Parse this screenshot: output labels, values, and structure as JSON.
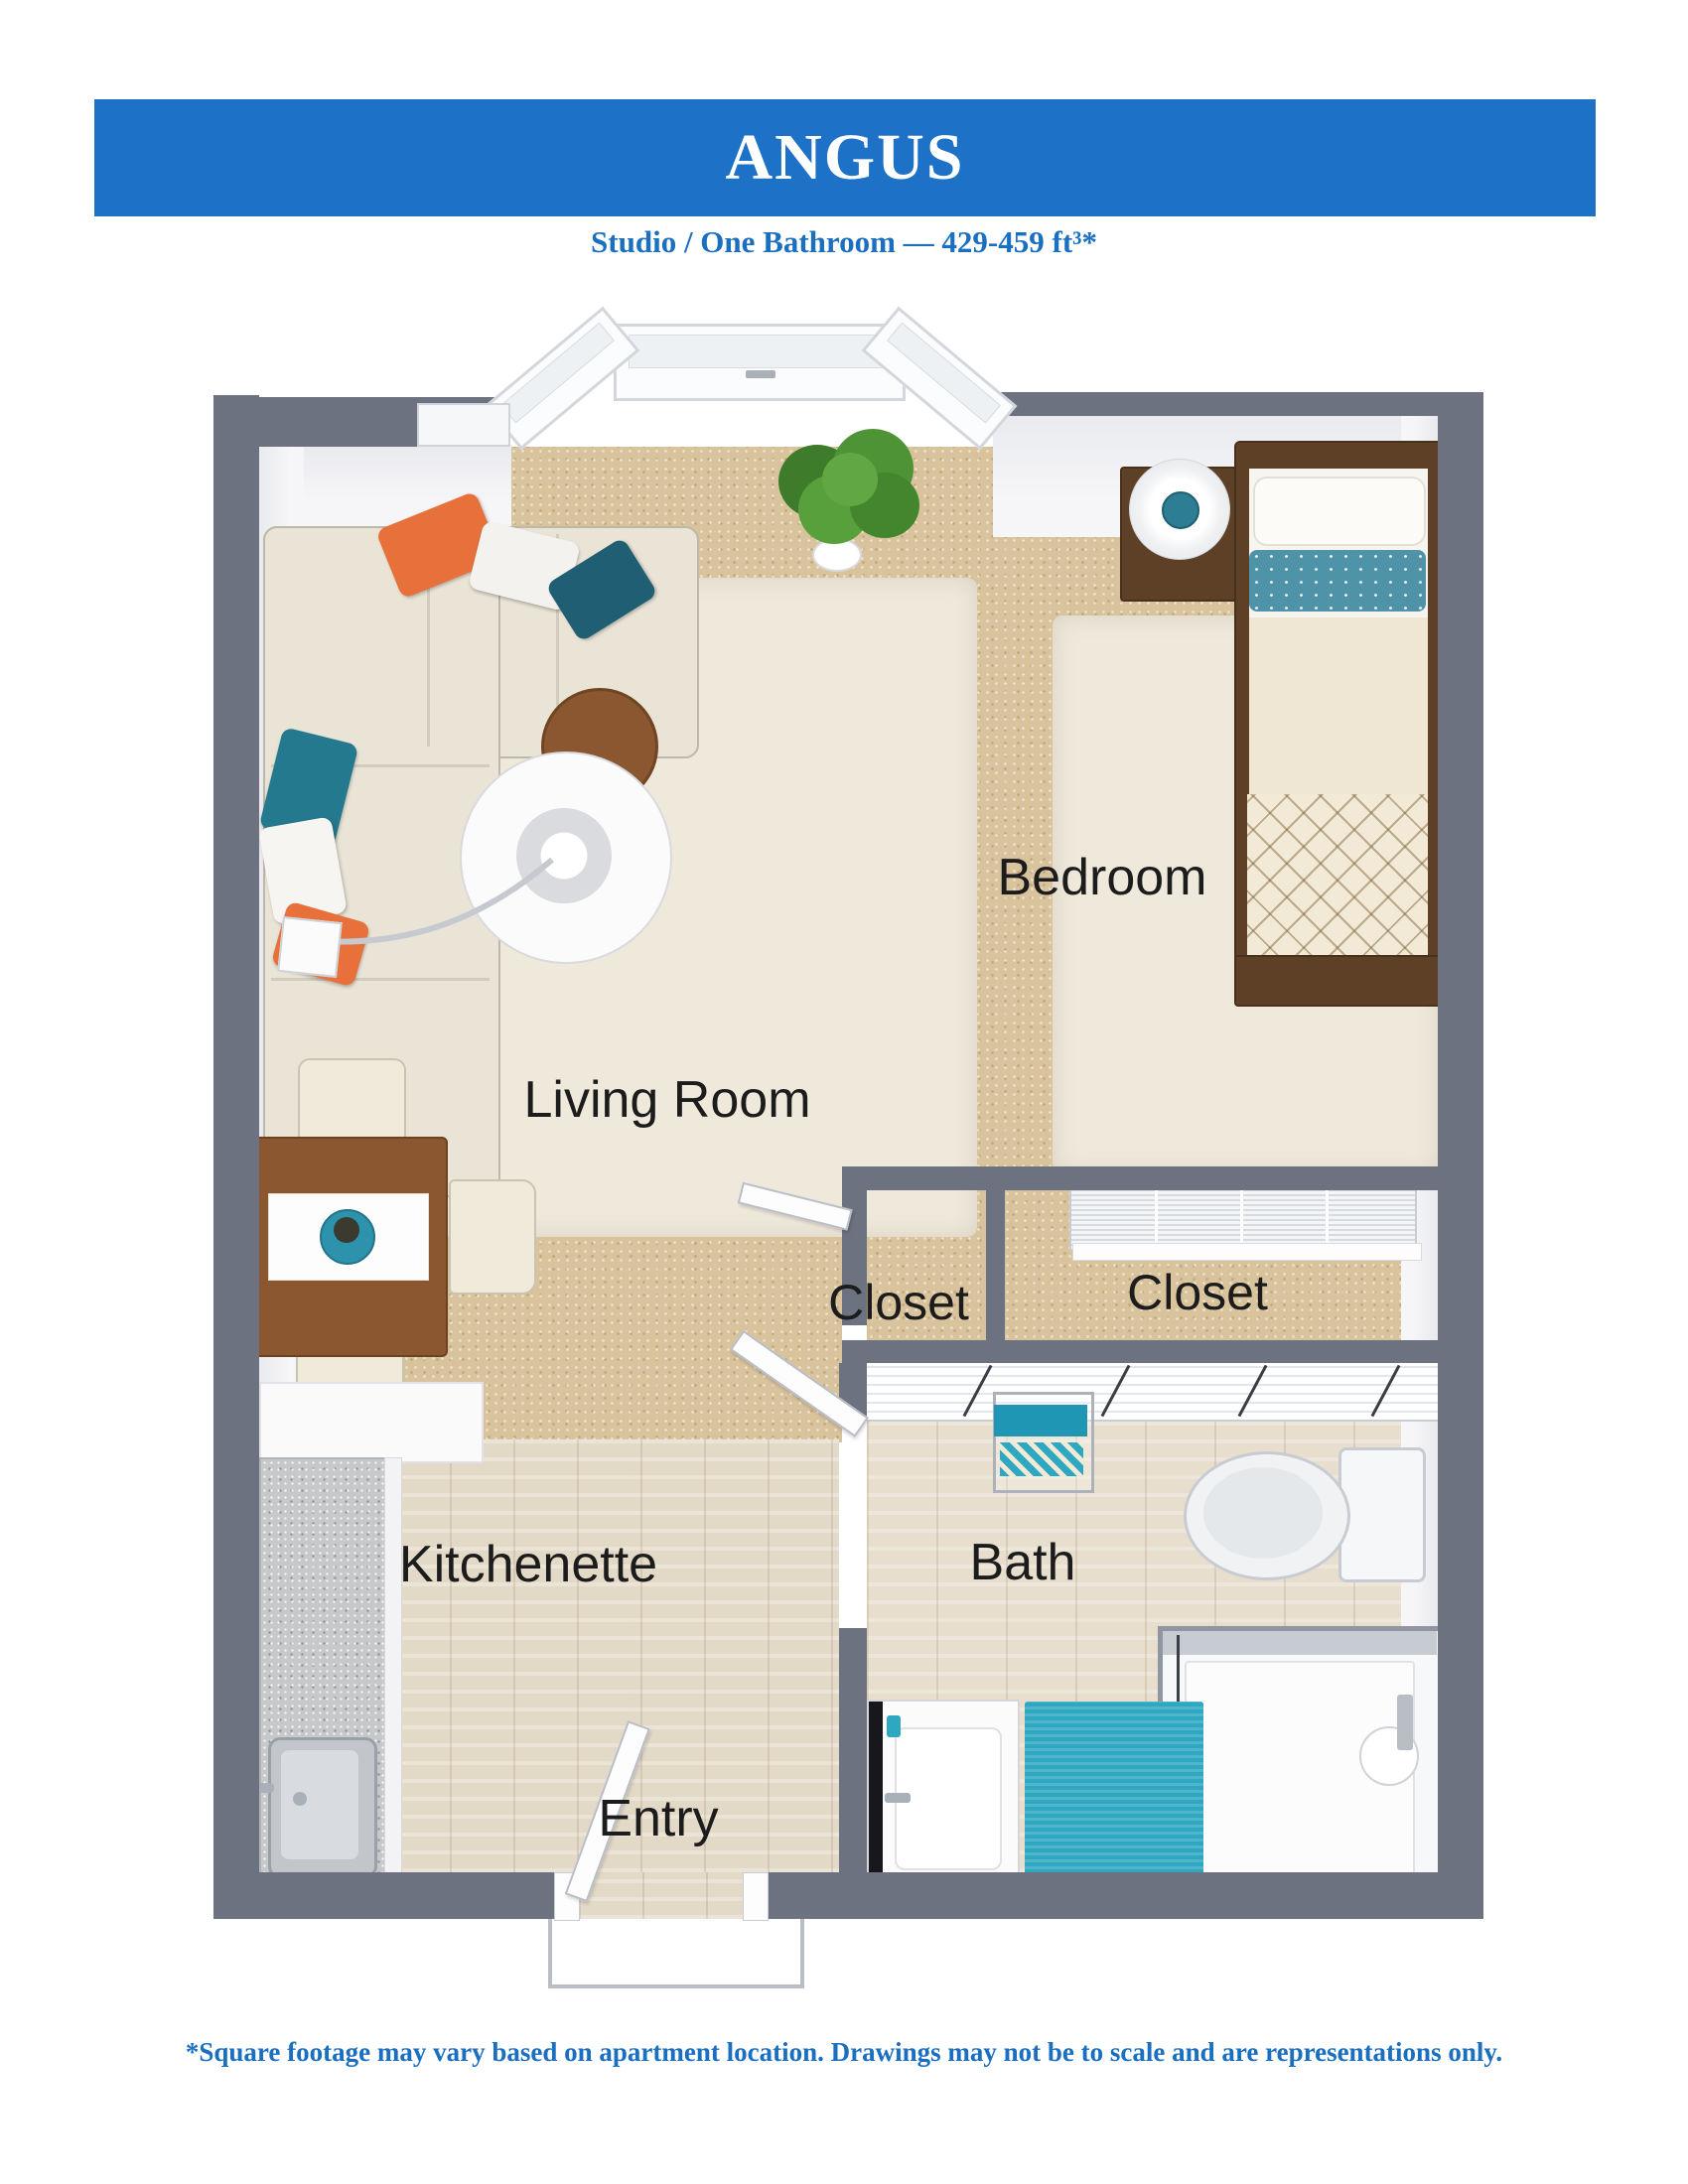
{
  "header": {
    "title": "ANGUS",
    "subtitle": "Studio / One Bathroom — 429-459 ft³*"
  },
  "floorplan": {
    "rooms": [
      {
        "id": "bedroom",
        "label": "Bedroom"
      },
      {
        "id": "living-room",
        "label": "Living Room"
      },
      {
        "id": "closet-left",
        "label": "Closet"
      },
      {
        "id": "closet-right",
        "label": "Closet"
      },
      {
        "id": "kitchenette",
        "label": "Kitchenette"
      },
      {
        "id": "bath",
        "label": "Bath"
      },
      {
        "id": "entry",
        "label": "Entry"
      }
    ],
    "furniture": [
      "sectional-sofa",
      "throw-pillows",
      "coffee-table",
      "arc-floor-lamp",
      "living-area-rug",
      "potted-plant",
      "dining-table",
      "dining-chairs",
      "centerpiece-bowl",
      "twin-bed",
      "nightstand",
      "table-lamp",
      "bedroom-rug",
      "louvered-closet-doors",
      "towel-rack",
      "toilet",
      "shower",
      "vanity-sink",
      "bath-rug",
      "kitchen-counter",
      "kitchen-sink"
    ]
  },
  "footer": {
    "disclaimer": "*Square footage may vary based on apartment location. Drawings may not be to scale and are representations only."
  },
  "colors": {
    "banner_blue": "#1D71C6",
    "banner_text": "#FFFFFF",
    "accent_text_blue": "#1A6FC0",
    "wall_gray": "#6C7280",
    "carpet_tan": "#D8C39C",
    "wood_floor": "#E3D9C7",
    "rug_cream": "#EFE9DC",
    "accent_teal": "#2EA7C1",
    "accent_orange": "#E8713B",
    "label_black": "#1C1C1C"
  }
}
